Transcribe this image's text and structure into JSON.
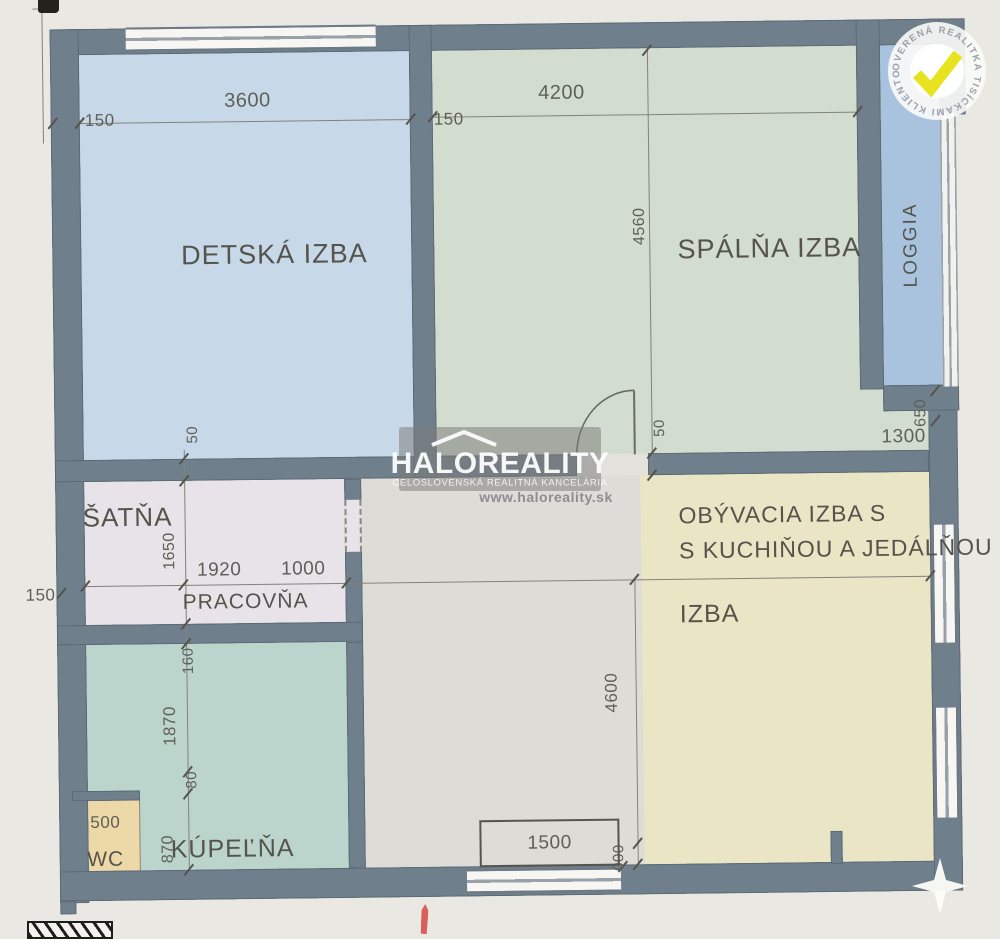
{
  "colors": {
    "background": "#eae8e2",
    "wall": "#6f7f8c",
    "detska": "#c7d9e8",
    "spalna": "#d2ddcf",
    "loggia": "#a9c3de",
    "satna": "#e7e3e8",
    "hall": "#dedcd7",
    "obyvacia": "#e9e5c5",
    "kupelna": "#bbd5cd",
    "wc": "#edd9a7",
    "badge_check": "#e7e41f"
  },
  "watermark": {
    "brand": "HALOREALITY",
    "subtitle": "CELOSLOVENSKÁ REALITNÁ KANCELÁRIA",
    "url": "www.haloreality.sk"
  },
  "badge": {
    "ring_text": "OVERENÁ REALITKA TISÍCKAMI KLIENTOV ✶"
  },
  "rooms": {
    "detska": {
      "label": "DETSKÁ IZBA"
    },
    "spalna": {
      "label": "SPÁLŇA IZBA"
    },
    "loggia": {
      "label": "LOGGIA"
    },
    "satna": {
      "label": "ŠATŇA"
    },
    "pracovna": {
      "label": "PRACOVŇA"
    },
    "kupelna": {
      "label": "KÚPEĽŇA"
    },
    "wc": {
      "label": "WC"
    },
    "obyvacia": {
      "label_line1": "OBÝVACIA IZBA S",
      "label_line2": "S KUCHIŇOU A JEDÁLŇOU",
      "label_line3": "IZBA"
    }
  },
  "dimensions": {
    "detska_width": "3600",
    "wall_top_left": "150",
    "wall_top_mid": "150",
    "spalna_width": "4200",
    "spalna_height": "4560",
    "loggia_depth": "650",
    "loggia_width": "1300",
    "wall_mid_left": "50",
    "wall_mid_right": "50",
    "left_margin": "150",
    "satna_height": "1650",
    "satna_width": "1920",
    "pracovna_width": "1000",
    "kupelna_top": "160",
    "kupelna_height": "1870",
    "kupelna_gap": "80",
    "kupelna_lower": "870",
    "wc_width": "500",
    "window_width": "1500",
    "obyvacia_height": "4600",
    "obyvacia_bottom": "000"
  }
}
